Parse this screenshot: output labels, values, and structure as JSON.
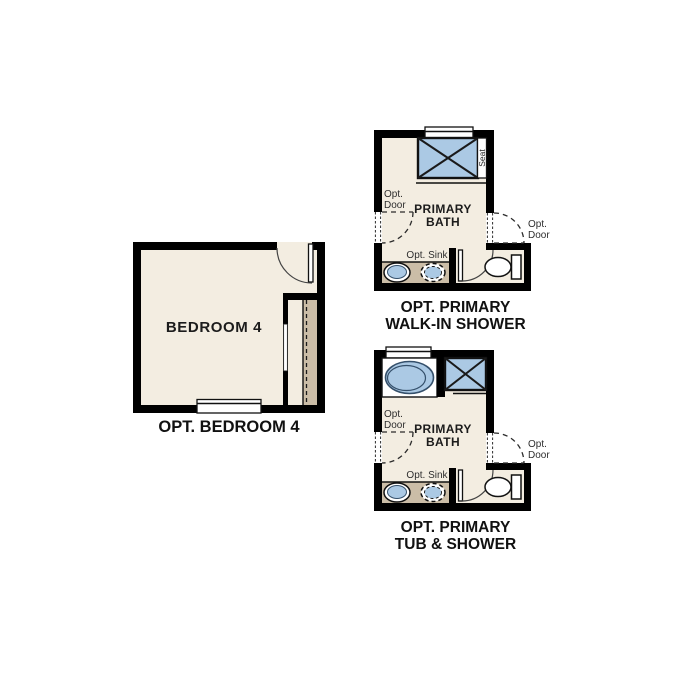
{
  "colors": {
    "background": "#ffffff",
    "floor": "#f3ede1",
    "counter_tan": "#cbbda7",
    "fixture_blue": "#abc9e4",
    "wall_black": "#000000"
  },
  "bedroom": {
    "room_label": "BEDROOM 4",
    "caption": "OPT. BEDROOM 4"
  },
  "walk_in_bath": {
    "room_line1": "PRIMARY",
    "room_line2": "BATH",
    "seat": "Seat",
    "left_door_line1": "Opt.",
    "left_door_line2": "Door",
    "right_door_line1": "Opt.",
    "right_door_line2": "Door",
    "sink": "Opt. Sink",
    "caption_line1": "OPT. PRIMARY",
    "caption_line2": "WALK-IN SHOWER"
  },
  "tub_bath": {
    "room_line1": "PRIMARY",
    "room_line2": "BATH",
    "left_door_line1": "Opt.",
    "left_door_line2": "Door",
    "right_door_line1": "Opt.",
    "right_door_line2": "Door",
    "sink": "Opt. Sink",
    "caption_line1": "OPT. PRIMARY",
    "caption_line2": "TUB & SHOWER"
  }
}
